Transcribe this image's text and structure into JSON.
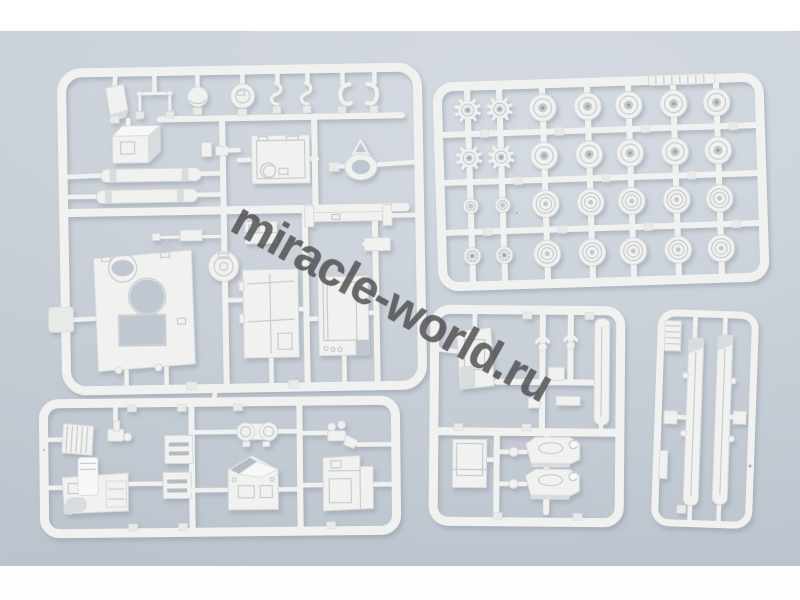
{
  "scene": {
    "subject": "photo of white injection-molded plastic model kit sprues (armored vehicle parts) on a pale blue-gray studio backdrop",
    "sprue_count": 5
  },
  "palette": {
    "band_top": "#ffffff",
    "band_bottom": "#fdfdfc",
    "backdrop_top": "#d2d8df",
    "backdrop_bottom": "#c6ced7",
    "plastic": "#f1f2f0",
    "plastic_bright": "#f8f8f6",
    "plastic_shadow": "#d9dcde",
    "plastic_edge": "#d7dadb",
    "detail": "#c6cbcf",
    "hole": "#bfc7d0",
    "tab": "#e8eae8",
    "dark_dot": "#9aa0a6",
    "dark_face": "#b4bcc3",
    "shadow": "#8d98a4"
  },
  "watermark": {
    "text": "miracle-world.ru",
    "color": "#4e4e50",
    "opacity": 0.82,
    "rotation_deg": 29
  },
  "sprues": [
    {
      "id": "sprue-hull-and-hatches",
      "position": "top-left",
      "parts": [
        "stowage-bin-small",
        "grab-handle-frame",
        "dome-hatch",
        "round-hatch",
        "clamp",
        "clamp",
        "towing-hook",
        "towing-hook",
        "stowage-box",
        "exhaust-pipe",
        "exhaust-pipe",
        "small-bracket",
        "engine-deck",
        "towing-ring",
        "machine-gun",
        "cupola-ring",
        "access-panel",
        "mount-bracket",
        "hull-top-plate",
        "rear-door-left",
        "rear-door-right"
      ]
    },
    {
      "id": "sprue-road-wheels",
      "position": "top-right",
      "parts": [
        {
          "name": "drive-sprocket",
          "count": 4
        },
        {
          "name": "road-wheel-hub",
          "count": 10
        },
        {
          "name": "road-wheel-ribbed",
          "count": 10
        },
        {
          "name": "idler-hub",
          "count": 2
        },
        {
          "name": "spoked-wheel",
          "count": 2
        },
        {
          "name": "track-strip",
          "count": 1
        }
      ]
    },
    {
      "id": "sprue-hatch-and-turrets",
      "position": "bottom-center",
      "parts": [
        "hatch-panel-upper",
        "tow-shackle",
        "tow-shackle",
        "small-box",
        "small-bar",
        "small-angle",
        "hatch-panel-lower",
        "mg-turret",
        "mg-turret",
        "side-skirt-strip"
      ]
    },
    {
      "id": "sprue-fenders",
      "position": "bottom-right",
      "parts": [
        "ribbed-plate",
        "fender-left",
        "fender-right",
        "bracket-left",
        "bracket-right",
        "side-strip"
      ]
    },
    {
      "id": "sprue-engine-parts",
      "position": "bottom-left",
      "parts": [
        "radiator-grille",
        "fuel-pump",
        "engine-block",
        "ribbed-box",
        "ribbed-box",
        "muffler",
        "cab-roof",
        "small-fittings",
        "stowage-tray"
      ]
    }
  ],
  "wheel_sprue": {
    "frame": {
      "w": 322,
      "h": 200,
      "rx": 16
    },
    "columns_x": [
      30,
      62,
      105,
      150,
      191,
      236,
      279
    ],
    "rails_y": [
      48,
      96,
      146
    ],
    "rows": [
      {
        "y": 24,
        "types": [
          "sprocket",
          "sprocket",
          "donut",
          "donut",
          "donut",
          "donut",
          "donut"
        ]
      },
      {
        "y": 72,
        "types": [
          "sprocket",
          "sprocket",
          "donut",
          "donut",
          "donut",
          "donut",
          "donut"
        ]
      },
      {
        "y": 120,
        "types": [
          "hub",
          "hub",
          "road",
          "road",
          "road",
          "road",
          "road"
        ]
      },
      {
        "y": 170,
        "types": [
          "spoked",
          "spoked",
          "road",
          "road",
          "road",
          "road",
          "road"
        ]
      }
    ]
  }
}
